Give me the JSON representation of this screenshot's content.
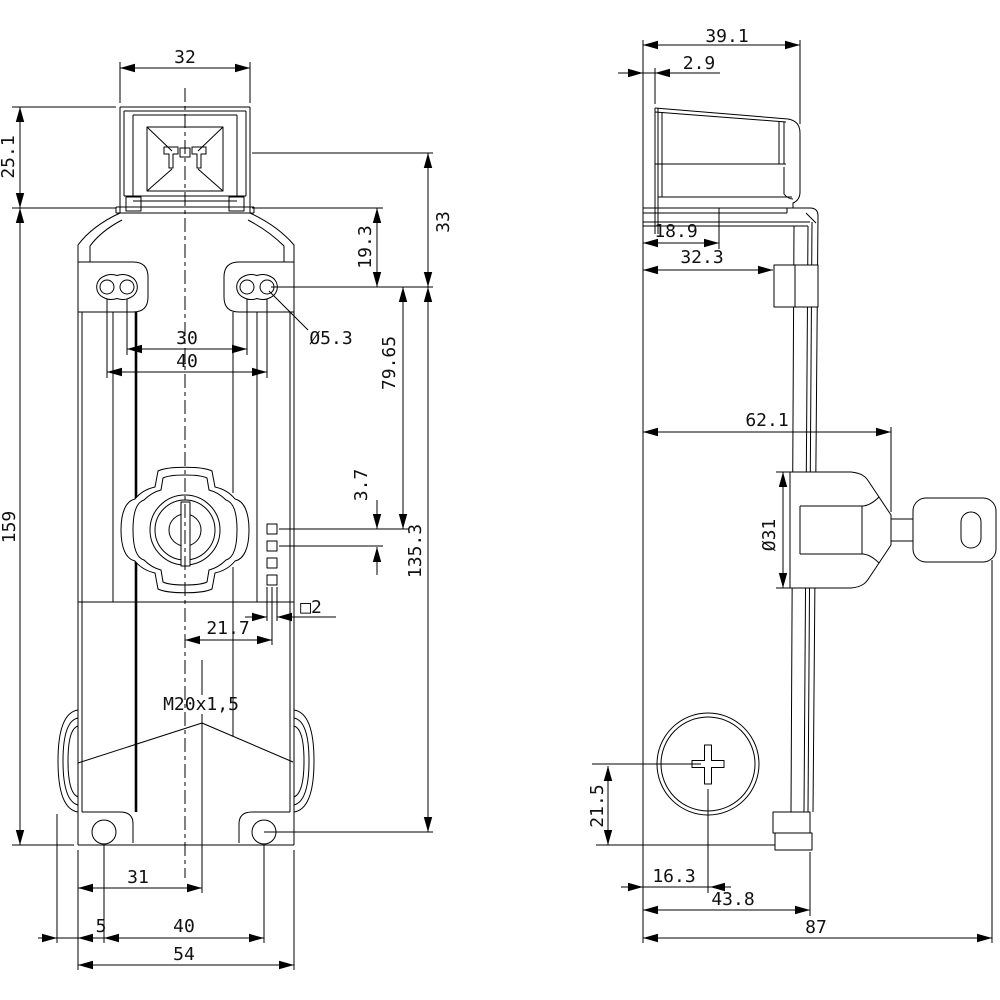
{
  "drawing": {
    "type": "technical-dimension-drawing",
    "line_color": "#000000",
    "background": "#ffffff",
    "front_view": {
      "dims": {
        "head_width": "32",
        "head_height": "25.1",
        "total_length": "159",
        "shoulder_to_holes": "19.3",
        "head_line_to_holes": "33",
        "mount_hole_dia": "Ø5.3",
        "hole_pitch_inner": "30",
        "hole_pitch_outer": "40",
        "holes_to_contact": "79.65",
        "contact_pitch": "3.7",
        "hole_rows_span": "135.3",
        "contact_offset": "21.7",
        "contact_square": "□2",
        "conduit_thread": "M20x1,5",
        "conduit_offset": "31",
        "gland_overhang": "5",
        "bottom_hole_pitch": "40",
        "body_width": "54"
      }
    },
    "side_view": {
      "dims": {
        "head_depth": "39.1",
        "face_offset": "2.9",
        "flange_depth": "18.9",
        "bracket_depth": "32.3",
        "lock_depth": "62.1",
        "lock_dia": "Ø31",
        "screw_center_height": "21.5",
        "screw_center_offset": "16.3",
        "base_depth": "43.8",
        "total_depth": "87"
      }
    }
  }
}
